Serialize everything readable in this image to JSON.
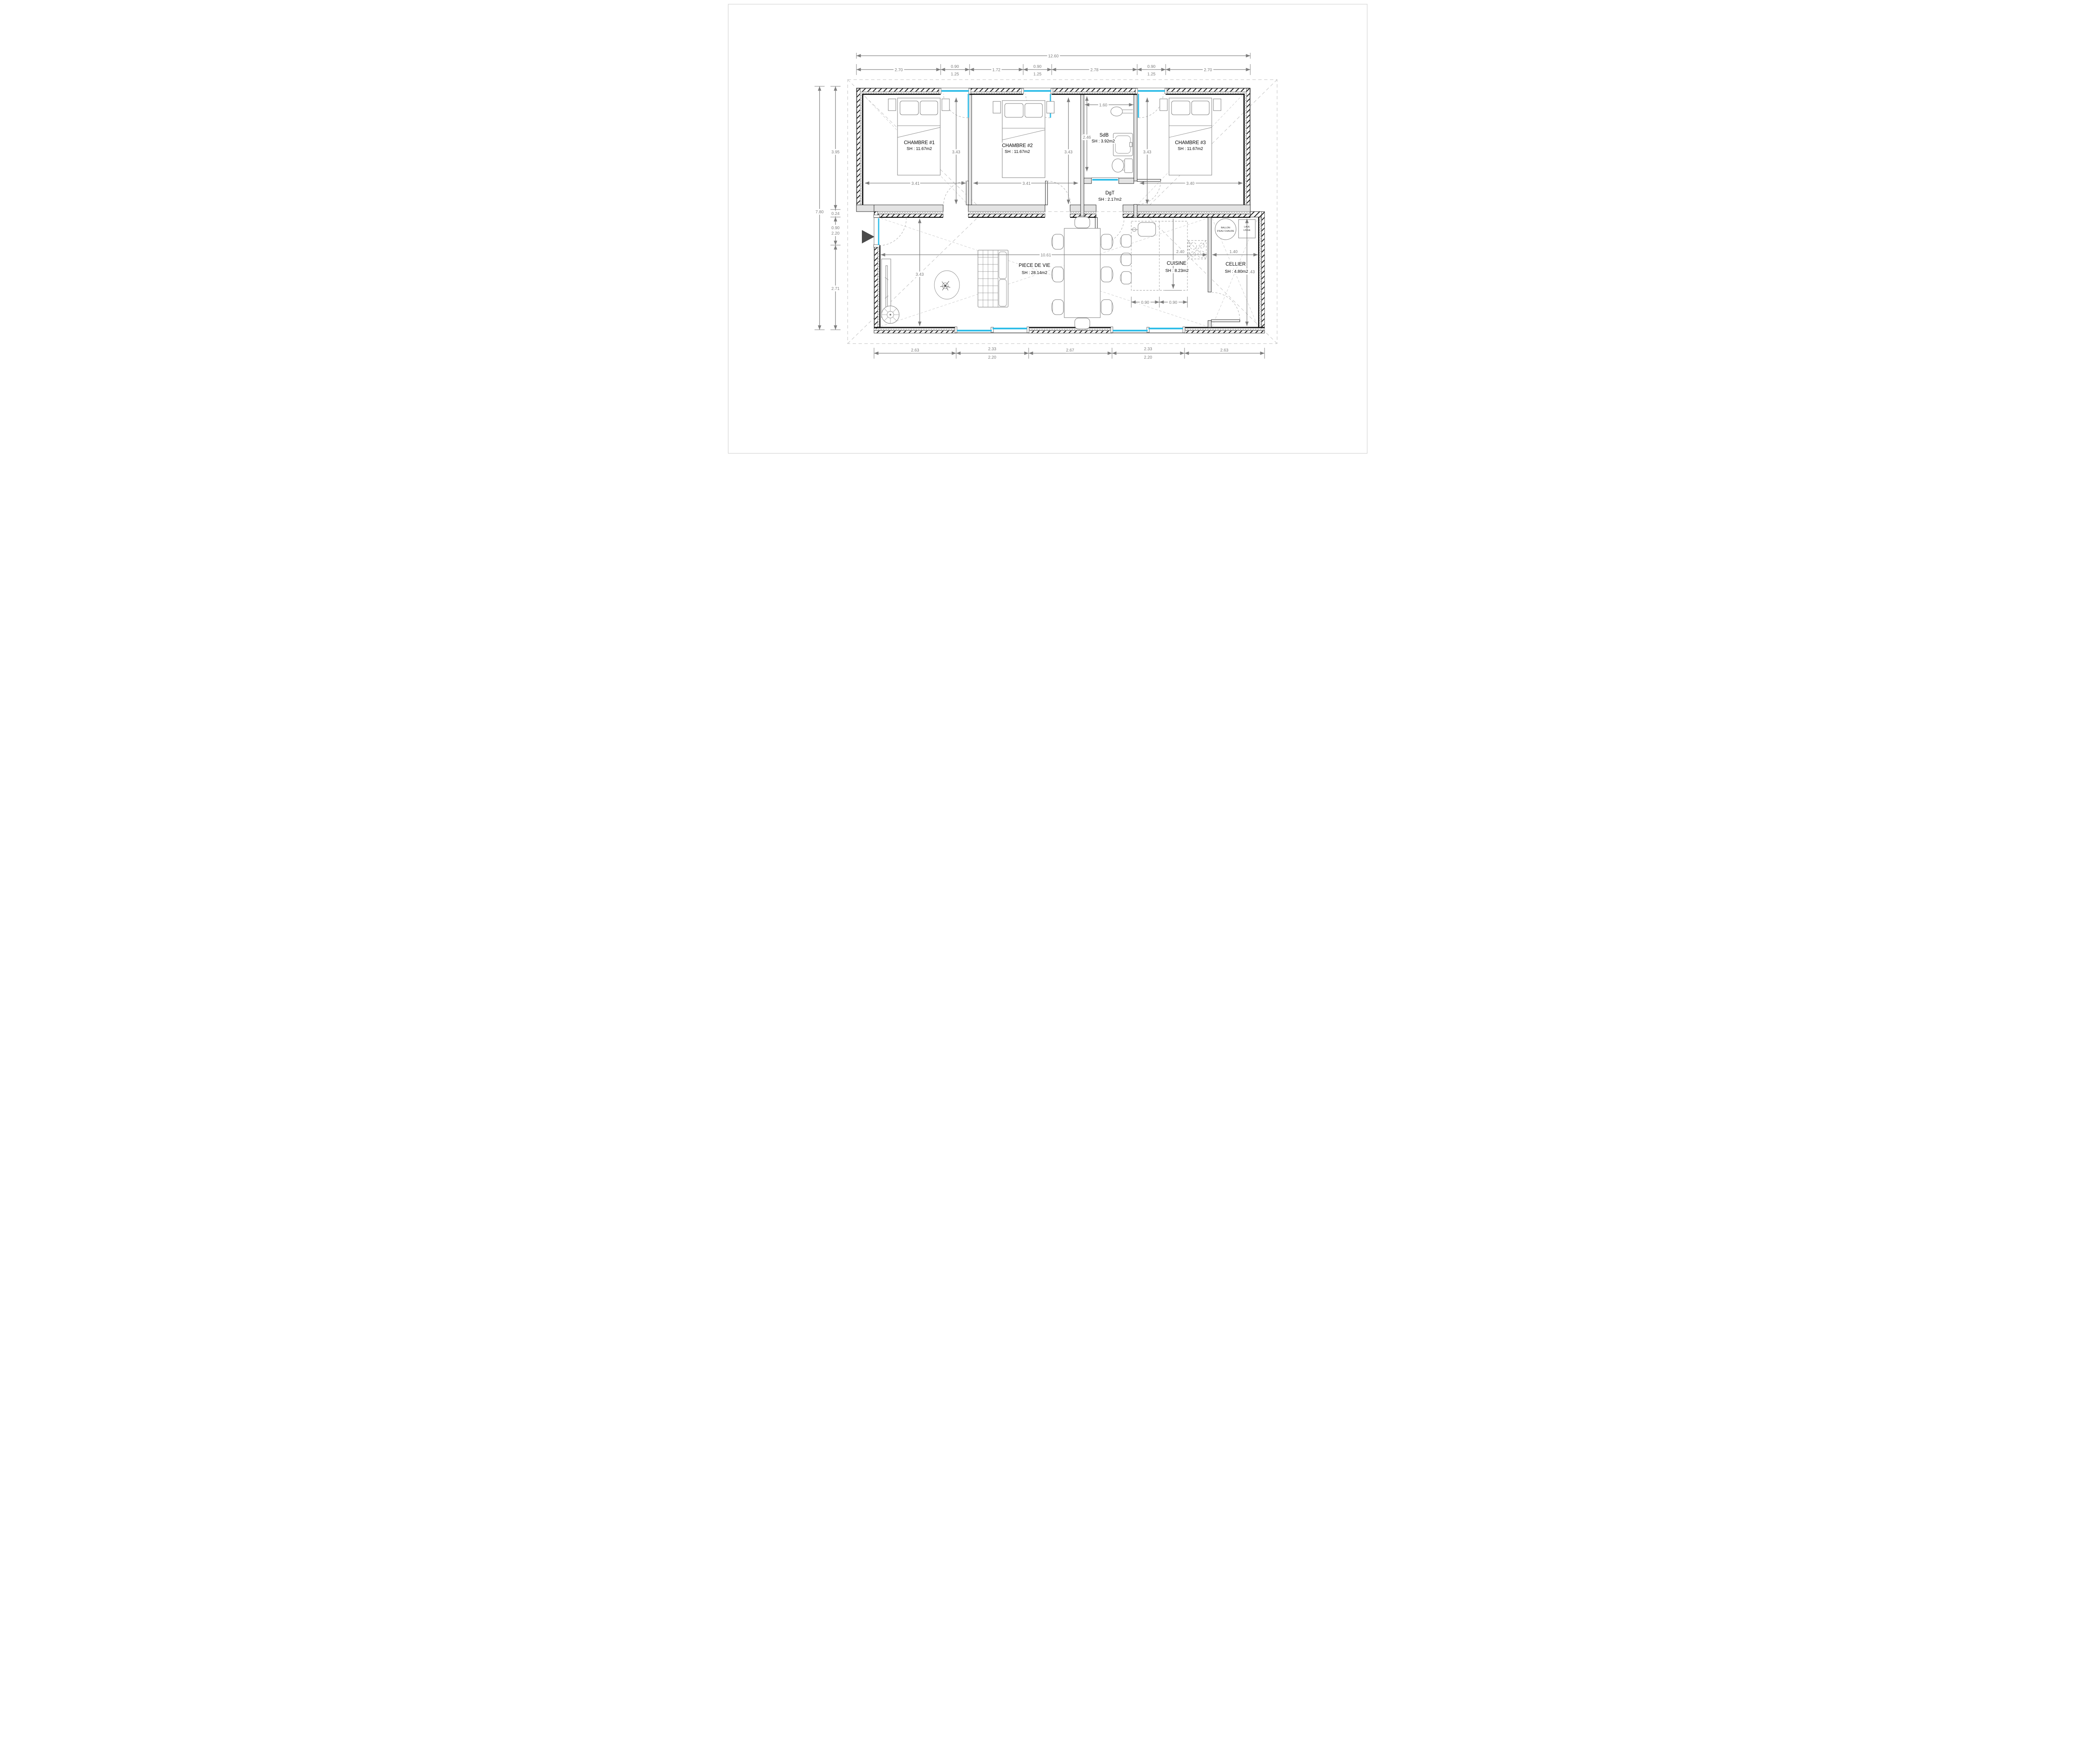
{
  "drawing": {
    "type": "floor-plan",
    "language": "fr"
  },
  "rooms": {
    "chambre1": {
      "name": "CHAMBRE #1",
      "area": "SH : 11.67m2"
    },
    "chambre2": {
      "name": "CHAMBRE #2",
      "area": "SH : 11.67m2"
    },
    "chambre3": {
      "name": "CHAMBRE #3",
      "area": "SH : 11.67m2"
    },
    "sdb": {
      "name": "SdB",
      "area": "SH : 3.92m2"
    },
    "dgt": {
      "name": "DgT",
      "area": "SH : 2.17m2"
    },
    "piece_de_vie": {
      "name": "PIECE DE VIE",
      "area": "SH : 28.14m2"
    },
    "cuisine": {
      "name": "CUISINE",
      "area": "SH : 8.23m2"
    },
    "cellier": {
      "name": "CELLIER",
      "area": "SH : 4.80m2"
    }
  },
  "equipment": {
    "ballon_line1": "BALLON",
    "ballon_line2": "D'EAU CHAUDE",
    "lave_line1": "LAVE",
    "lave_line2": "LINGE"
  },
  "dims": {
    "top_total": "12.60",
    "top": [
      "2.70",
      "0.90",
      "1.25",
      "1.72",
      "0.90",
      "1.25",
      "2.78",
      "0.90",
      "1.25",
      "2.70"
    ],
    "left_total": "7.80",
    "left": [
      "3.95",
      "0.24",
      "0.90",
      "2.20",
      "2.71"
    ],
    "bottom": [
      "2.63",
      "2.33",
      "2.20",
      "2.67",
      "2.33",
      "2.20",
      "2.63"
    ],
    "interior": {
      "ch1_w": "3.41",
      "ch1_h": "3.43",
      "ch2_w": "3.41",
      "ch2_h": "3.43",
      "ch3_w": "3.40",
      "ch3_h": "3.43",
      "sdb_w": "1.60",
      "sdb_h": "2.46",
      "living_w": "10.61",
      "living_h": "3.43",
      "cuisine_d": "2.40",
      "island": [
        "0.90",
        "0.90"
      ],
      "cellier_w": "1.40",
      "cellier_h": "3.43"
    }
  },
  "colors": {
    "window": "#2FBDE8",
    "dim": "#7d7d7d",
    "wall": "#111111"
  }
}
